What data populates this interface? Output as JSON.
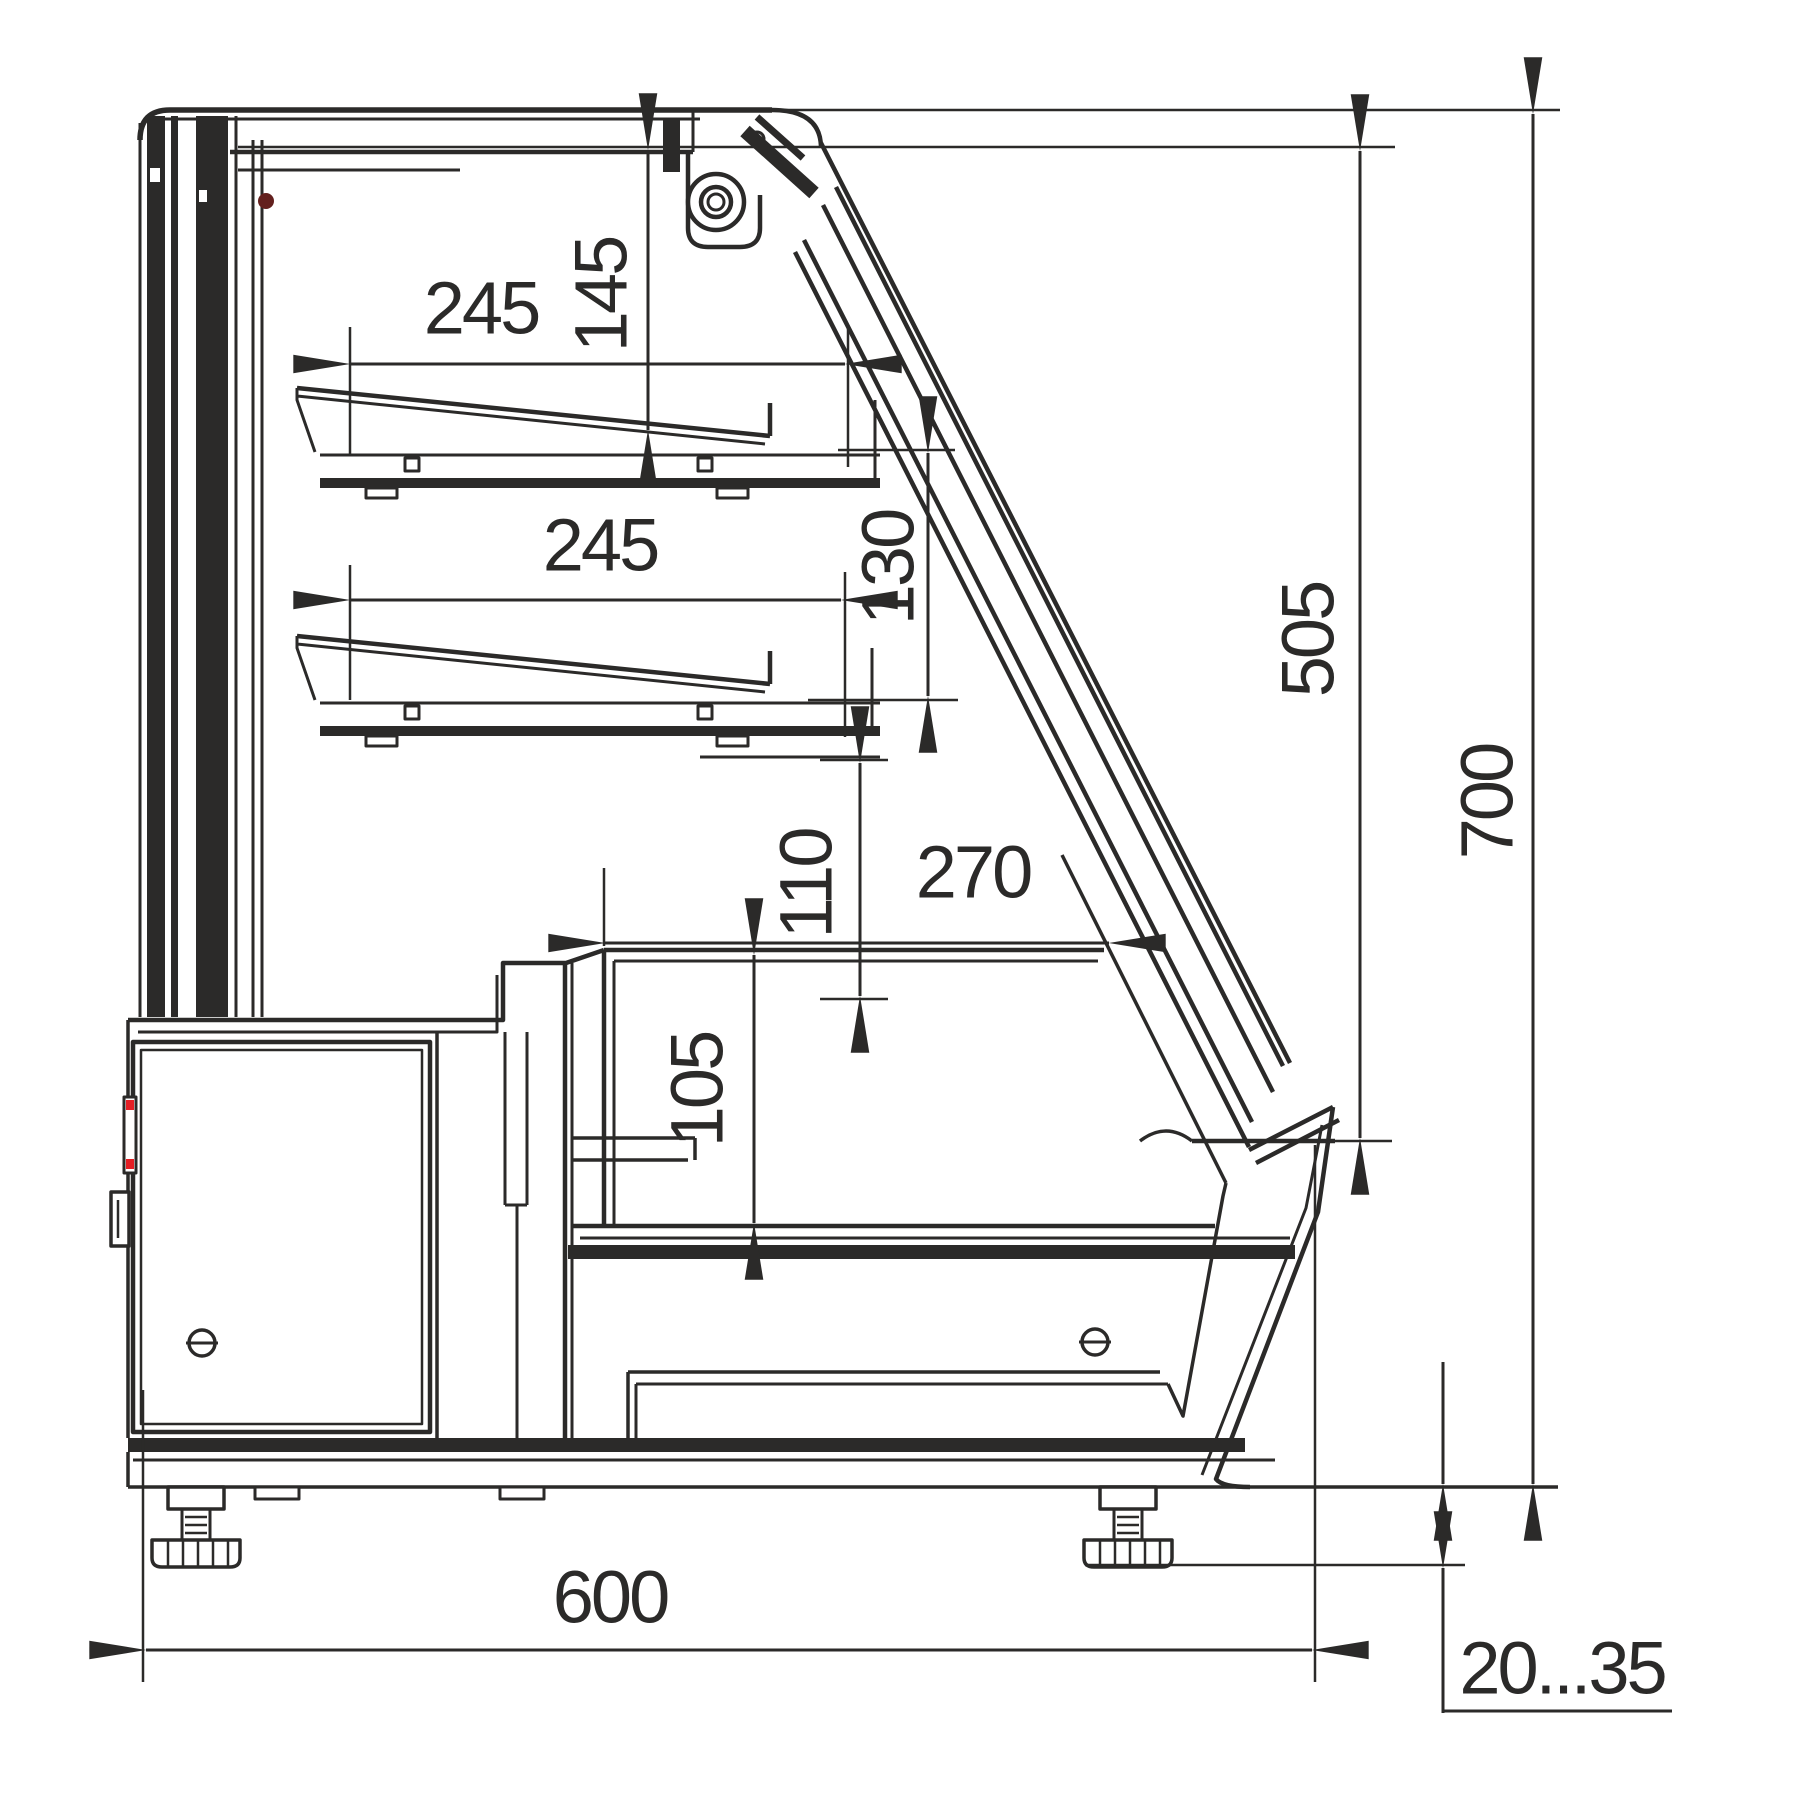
{
  "drawing": {
    "kind": "technical side-section drawing of a refrigerated display counter",
    "dimensions": {
      "shelf_upper_depth": "245",
      "shelf_upper_clearance": "145",
      "shelf_lower_depth": "245",
      "shelf_lower_clearance": "130",
      "well_clearance": "110",
      "well_width": "270",
      "well_depth": "105",
      "front_glass_height": "505",
      "overall_height": "700",
      "overall_depth": "600",
      "foot_adjust_range": "20...35"
    },
    "colors": {
      "line": "#2b2a29",
      "background": "#ffffff",
      "accent_red": "#e31e24",
      "accent_dark_red": "#63201e"
    }
  }
}
